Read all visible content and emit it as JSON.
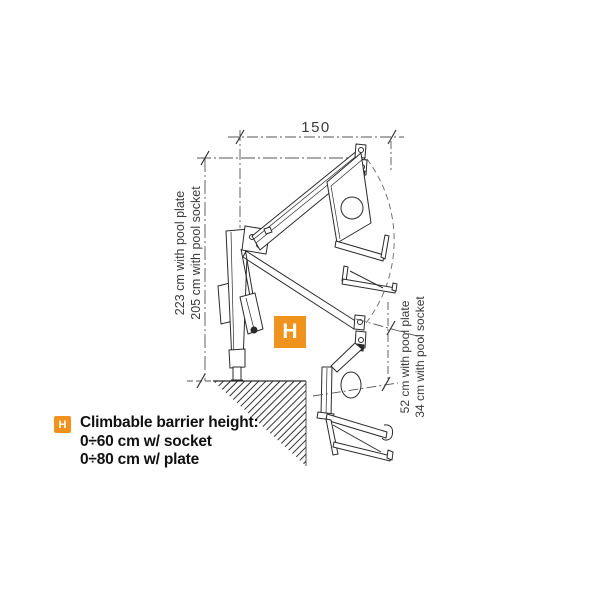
{
  "diagram": {
    "top_dimension": "150",
    "left_dimension": [
      "223 cm with pool plate",
      "205 cm with pool socket"
    ],
    "right_dimension": [
      "52 cm with pool plate",
      "34 cm with pool socket"
    ],
    "marker": "H"
  },
  "legend": {
    "marker": "H",
    "title": "Climbable barrier height:",
    "lines": [
      "0÷60 cm w/ socket",
      "0÷80 cm w/ plate"
    ]
  },
  "colors": {
    "accent": "#F0931E",
    "ink": "#2b2b2b",
    "reference": "#555555"
  }
}
